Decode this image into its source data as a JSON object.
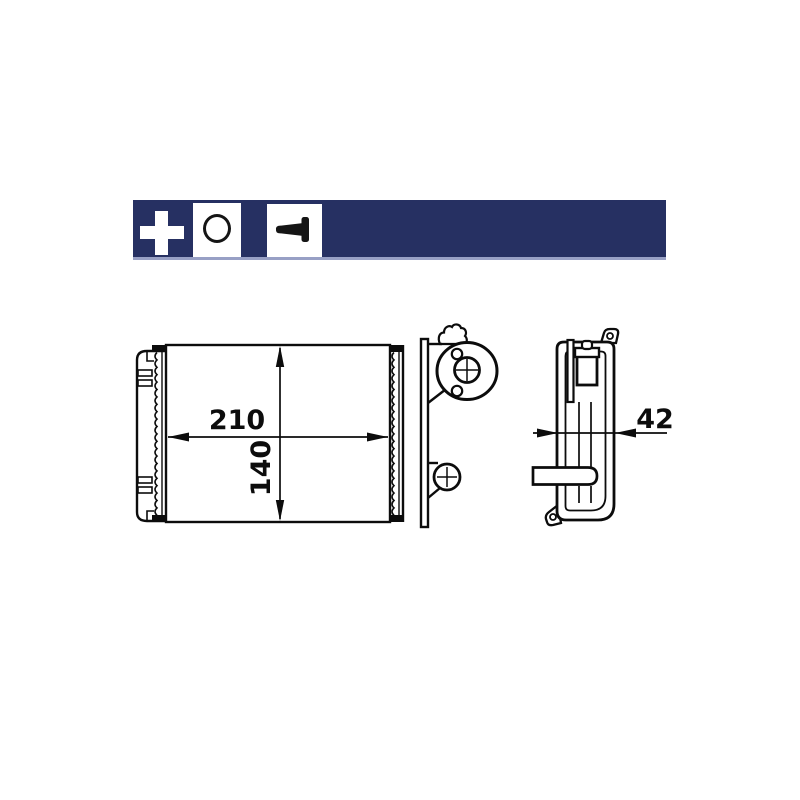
{
  "page": {
    "background_color": "#ffffff"
  },
  "toolbar": {
    "background_color": "#263062",
    "underline_color": "#98a0c5",
    "buttons": [
      {
        "icon": "plus-icon",
        "icon_color": "#ffffff",
        "background": "#263062"
      },
      {
        "icon": "ring-icon",
        "icon_color": "#151515",
        "background": "#ffffff"
      },
      {
        "icon": "pin-icon",
        "icon_color": "#151515",
        "background": "#ffffff"
      }
    ]
  },
  "drawing": {
    "line_color": "#0c0c0c",
    "views": [
      {
        "name": "front-view",
        "dimensions": [
          {
            "label": "210",
            "orientation": "horizontal"
          },
          {
            "label": "140",
            "orientation": "vertical"
          }
        ]
      },
      {
        "name": "side-view",
        "dimensions": [
          {
            "label": "42",
            "orientation": "horizontal"
          }
        ]
      }
    ]
  }
}
